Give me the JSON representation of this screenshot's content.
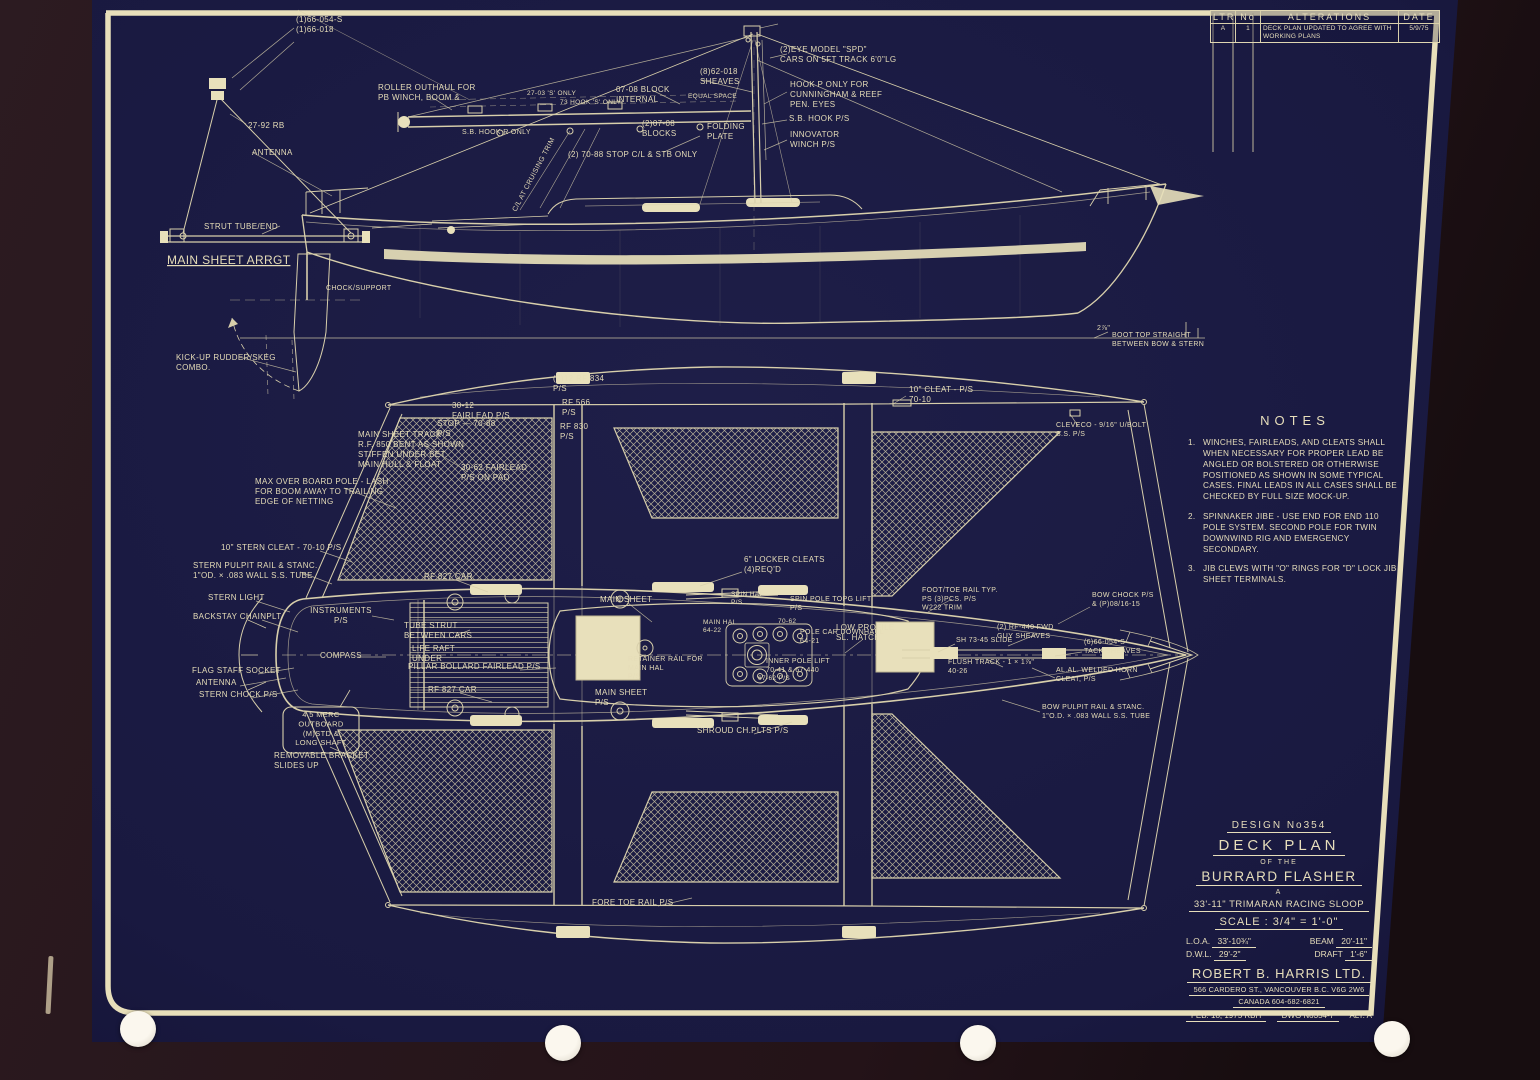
{
  "alterations": {
    "col_ltr": "LTR",
    "col_no": "No",
    "col_title": "ALTERATIONS",
    "col_date": "DATE",
    "row": {
      "ltr": "A",
      "no": "1",
      "text": "DECK PLAN UPDATED TO AGREE WITH WORKING PLANS",
      "date": "5/9/75"
    }
  },
  "notes": {
    "title": "NOTES",
    "items": [
      {
        "num": "1.",
        "text": "WINCHES, FAIRLEADS, AND CLEATS SHALL WHEN NECESSARY FOR PROPER LEAD BE ANGLED OR BOLSTERED OR OTHERWISE POSITIONED AS SHOWN IN SOME TYPICAL CASES. FINAL LEADS IN ALL CASES SHALL BE CHECKED BY FULL SIZE MOCK-UP."
      },
      {
        "num": "2.",
        "text": "SPINNAKER JIBE - USE END FOR END 110 POLE SYSTEM. SECOND POLE FOR TWIN DOWNWIND RIG AND EMERGENCY SECONDARY."
      },
      {
        "num": "3.",
        "text": "JIB CLEWS WITH \"O\" RINGS FOR \"D\" LOCK JIB SHEET TERMINALS."
      }
    ]
  },
  "title_block": {
    "design_no": "DESIGN No354",
    "title": "DECK PLAN",
    "of_the": "OF THE",
    "name": "BURRARD FLASHER",
    "article": "A",
    "type": "33'-11\" TRIMARAN RACING SLOOP",
    "scale": "SCALE : 3/4\" = 1'-0\"",
    "loa_label": "L.O.A.",
    "loa": "33'-10¾\"",
    "beam_label": "BEAM",
    "beam": "20'-11\"",
    "dwl_label": "D.W.L.",
    "dwl": "29'-2\"",
    "draft_label": "DRAFT",
    "draft": "1'-6\"",
    "firm": "ROBERT B. HARRIS LTD.",
    "address": "566 CARDERO ST., VANCOUVER B.C. V6G 2W6",
    "phone": "CANADA 604-682-6821",
    "date": "FEB. 18, 1975 RBH",
    "dwg": "DWG No354-7",
    "alt": "ALT. A"
  },
  "side_view_labels": [
    {
      "t": "(1)66-054-S\n(1)66-018",
      "x": 296,
      "y": 22
    },
    {
      "t": "27-92 RB",
      "x": 248,
      "y": 128
    },
    {
      "t": "ANTENNA",
      "x": 252,
      "y": 155
    },
    {
      "t": "STRUT TUBE/END",
      "x": 204,
      "y": 229
    },
    {
      "t": "MAIN SHEET ARRGT",
      "x": 167,
      "y": 264,
      "s": 12,
      "u": 1
    },
    {
      "t": "ROLLER OUTHAUL FOR\nPB WINCH, BOOM &",
      "x": 378,
      "y": 90
    },
    {
      "t": "27-03 'S' ONLY",
      "x": 527,
      "y": 95,
      "s": 6.5
    },
    {
      "t": "73 HOOK 'S' ONLY",
      "x": 560,
      "y": 104,
      "s": 6.5
    },
    {
      "t": "S.B. HOOK R ONLY",
      "x": 462,
      "y": 134,
      "s": 7
    },
    {
      "t": "(8)62-018\nSHEAVES",
      "x": 700,
      "y": 74
    },
    {
      "t": "07-08 BLOCK\nINTERNAL",
      "x": 616,
      "y": 92
    },
    {
      "t": "EQUAL SPACE",
      "x": 688,
      "y": 98,
      "s": 6.5
    },
    {
      "t": "(2)EYE MODEL \"SPD\"\nCARS ON 5FT TRACK 6'0\"LG",
      "x": 780,
      "y": 52
    },
    {
      "t": "HOOK P ONLY FOR\nCUNNINGHAM & REEF\nPEN. EYES",
      "x": 790,
      "y": 87
    },
    {
      "t": "S.B. HOOK P/S",
      "x": 789,
      "y": 121
    },
    {
      "t": "INNOVATOR\nWINCH P/S",
      "x": 790,
      "y": 137
    },
    {
      "t": "(2)07-08\nBLOCKS",
      "x": 642,
      "y": 126
    },
    {
      "t": "FOLDING\nPLATE",
      "x": 707,
      "y": 129
    },
    {
      "t": "(2) 70-88 STOP C/L & STB ONLY",
      "x": 568,
      "y": 157
    },
    {
      "t": "C/L AT CRUISING TRIM",
      "x": 516,
      "y": 212,
      "r": -62,
      "s": 7
    },
    {
      "t": "CHOCK/SUPPORT",
      "x": 326,
      "y": 290,
      "s": 7
    },
    {
      "t": "KICK-UP RUDDER/SKEG\nCOMBO.",
      "x": 176,
      "y": 360
    },
    {
      "t": "2⅞\"",
      "x": 1097,
      "y": 330,
      "s": 7
    },
    {
      "t": "BOOT TOP STRAIGHT\nBETWEEN BOW & STERN",
      "x": 1112,
      "y": 337,
      "s": 7
    }
  ],
  "deck_plan_labels": [
    {
      "t": "30-12\nFAIRLEAD P/S",
      "x": 452,
      "y": 408
    },
    {
      "t": "STOP — 70-88\nP/S",
      "x": 437,
      "y": 426
    },
    {
      "t": "(2)12 RF 834\nP/S",
      "x": 553,
      "y": 381
    },
    {
      "t": "RF 566\nP/S",
      "x": 562,
      "y": 405
    },
    {
      "t": "RF 830\nP/S",
      "x": 560,
      "y": 429
    },
    {
      "t": "30-62 FAIRLEAD\nP/S ON PAD",
      "x": 461,
      "y": 470
    },
    {
      "t": "MAIN SHEET TRACK\nR.F. 850 BENT AS SHOWN\nSTIFFEN UNDER BET.\nMAIN HULL & FLOAT",
      "x": 358,
      "y": 437
    },
    {
      "t": "MAX OVER BOARD POLE - LASH\nFOR BOOM AWAY TO TRAILING\nEDGE OF NETTING",
      "x": 255,
      "y": 484
    },
    {
      "t": "10\" STERN CLEAT - 70-10 P/S",
      "x": 221,
      "y": 550
    },
    {
      "t": "STERN PULPIT RAIL & STANC.\n1\"OD. × .083 WALL S.S. TUBE",
      "x": 193,
      "y": 568
    },
    {
      "t": "STERN LIGHT",
      "x": 208,
      "y": 600
    },
    {
      "t": "BACKSTAY CHAINPLT",
      "x": 193,
      "y": 619
    },
    {
      "t": "FLAG STAFF SOCKET",
      "x": 192,
      "y": 673
    },
    {
      "t": "ANTENNA",
      "x": 196,
      "y": 685
    },
    {
      "t": "STERN CHOCK P/S",
      "x": 199,
      "y": 697
    },
    {
      "t": "RF 827 CAR",
      "x": 424,
      "y": 579
    },
    {
      "t": "RF 827 CAR",
      "x": 428,
      "y": 692
    },
    {
      "t": "INSTRUMENTS\nP/S",
      "x": 341,
      "y": 613,
      "a": "m"
    },
    {
      "t": "COMPASS",
      "x": 320,
      "y": 658
    },
    {
      "t": "4.5 MERC\nOUTBOARD\n(M)STD &\nLONG SHAFT",
      "x": 321,
      "y": 717,
      "a": "m",
      "s": 7.5
    },
    {
      "t": "REMOVABLE BRACKET\nSLIDES UP",
      "x": 274,
      "y": 758
    },
    {
      "t": "TUBE STRUT\nBETWEEN CARS",
      "x": 404,
      "y": 628
    },
    {
      "t": "LIFE RAFT\nUNDER",
      "x": 412,
      "y": 651
    },
    {
      "t": "PILLAR BOLLARD FAIRLEAD P/S",
      "x": 408,
      "y": 669
    },
    {
      "t": "MAIN SHEET",
      "x": 600,
      "y": 602
    },
    {
      "t": "MAIN SHEET\nP/S",
      "x": 595,
      "y": 695
    },
    {
      "t": "6\" LOCKER CLEATS\n(4)REQ'D",
      "x": 744,
      "y": 562
    },
    {
      "t": "SPIN HAL\nP/S",
      "x": 731,
      "y": 596,
      "s": 6.5
    },
    {
      "t": "SPIN POLE TOPG LIFT\nP/S",
      "x": 790,
      "y": 601,
      "s": 7
    },
    {
      "t": "70-62",
      "x": 778,
      "y": 623,
      "s": 6.5
    },
    {
      "t": "POLE CAR DOWNHAUL\n64-21",
      "x": 800,
      "y": 634,
      "s": 7
    },
    {
      "t": "MAIN HAL\n64-22",
      "x": 703,
      "y": 624,
      "s": 6.5
    },
    {
      "t": "LOW PROFILE\nSL. HATCH",
      "x": 836,
      "y": 630
    },
    {
      "t": "RETAINER RAIL FOR\nMAIN HAL\nP/S",
      "x": 628,
      "y": 661,
      "s": 7
    },
    {
      "t": "INNER POLE LIFT\n70-41 & 67-440",
      "x": 766,
      "y": 663,
      "s": 7
    },
    {
      "t": "67-62 P/S",
      "x": 758,
      "y": 680,
      "s": 6.5
    },
    {
      "t": "FOOT/TOE RAIL TYP.\nPS (3)PCS. P/S\nW222 TRIM",
      "x": 922,
      "y": 592,
      "s": 7
    },
    {
      "t": "BOW CHOCK P/S\n& (P)08/16-15",
      "x": 1092,
      "y": 597,
      "s": 7
    },
    {
      "t": "(2) RF-440 FWD\nGUY SHEAVES",
      "x": 997,
      "y": 629,
      "s": 7
    },
    {
      "t": "SH 73-45 SLIDE",
      "x": 956,
      "y": 642,
      "s": 7
    },
    {
      "t": "(6)66-054-S\nTACK SHEAVES",
      "x": 1084,
      "y": 644,
      "s": 7
    },
    {
      "t": "FLUSH TRACK - 1 × 1⅞\"\n40-26",
      "x": 948,
      "y": 664,
      "s": 7
    },
    {
      "t": "AL.AL. WELDED HORN\nCLEAT, P/S",
      "x": 1056,
      "y": 672,
      "s": 7
    },
    {
      "t": "BOW PULPIT RAIL & STANC.\n1\"O.D. × .083 WALL S.S. TUBE",
      "x": 1042,
      "y": 709,
      "s": 7
    },
    {
      "t": "SHROUD CH.PLTS P/S",
      "x": 697,
      "y": 733
    },
    {
      "t": "FORE TOE RAIL P/S",
      "x": 592,
      "y": 905
    },
    {
      "t": "10\" CLEAT - P/S\n70-10",
      "x": 909,
      "y": 392
    },
    {
      "t": "CLEVECO - 9/16\" U/BOLT\nS.S. P/S",
      "x": 1056,
      "y": 427,
      "s": 7
    }
  ]
}
